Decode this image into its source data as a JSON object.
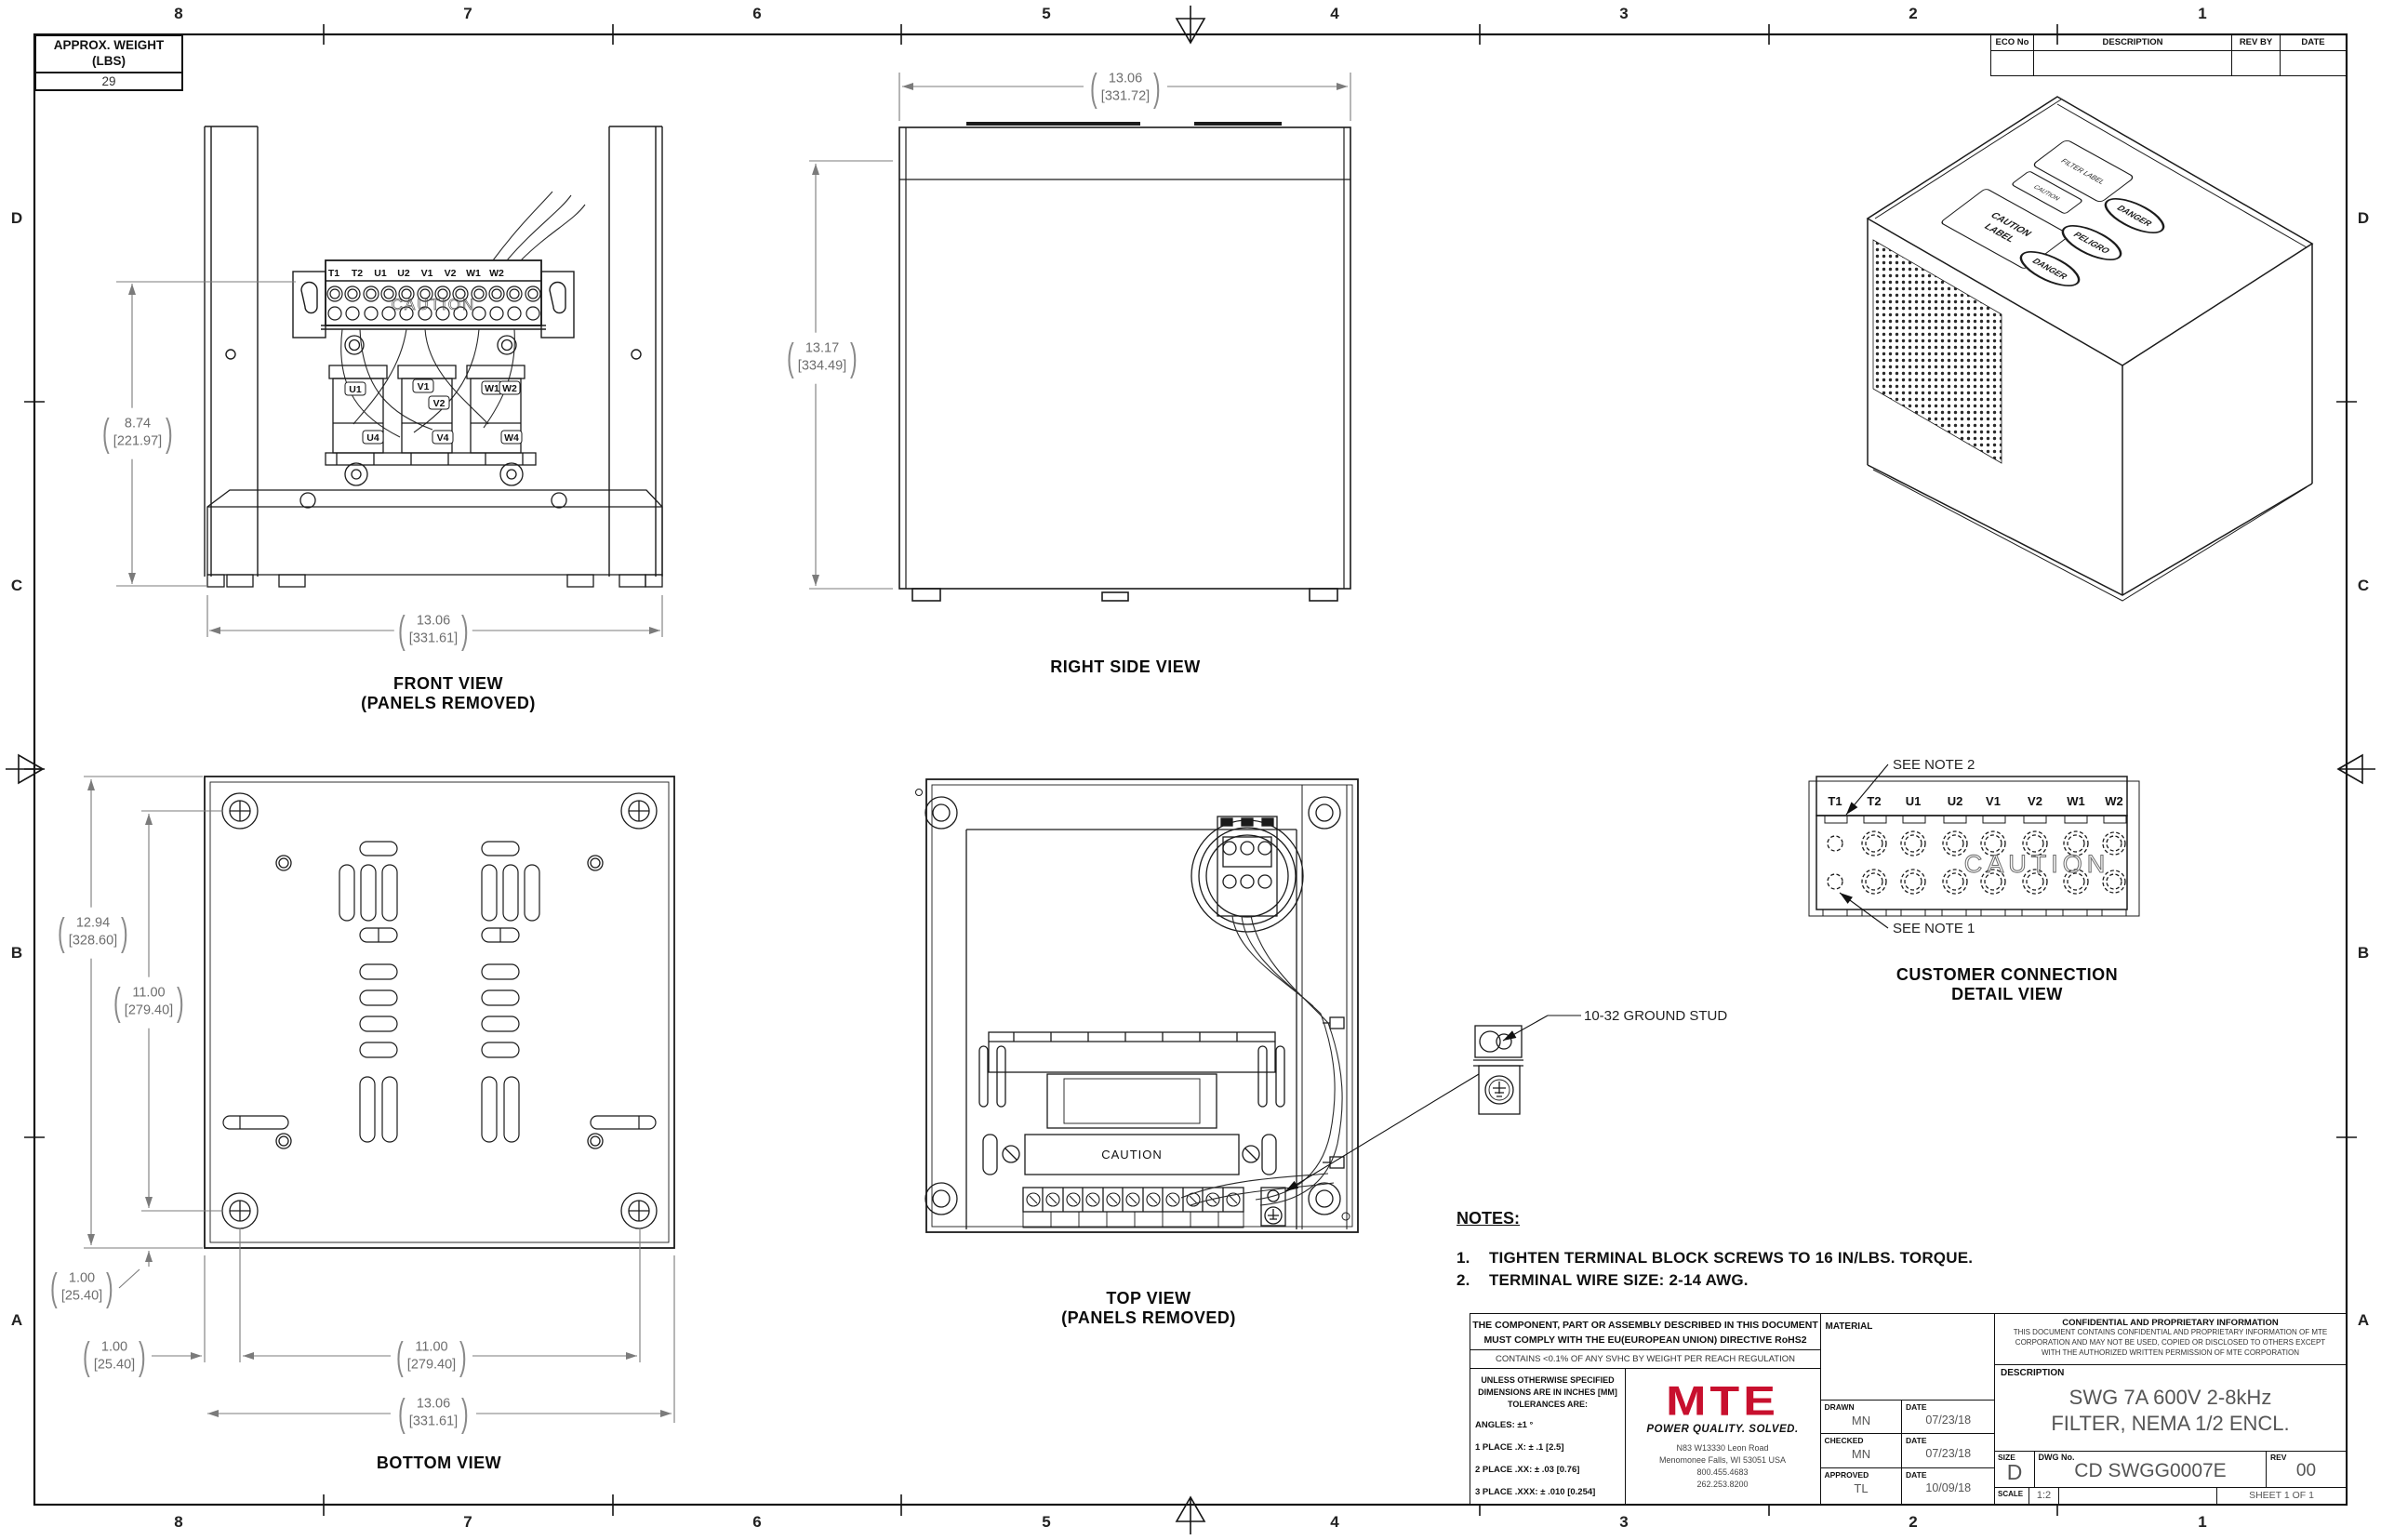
{
  "sheet": {
    "border": {
      "cols": [
        "8",
        "7",
        "6",
        "5",
        "4",
        "3",
        "2",
        "1"
      ],
      "rows": [
        "D",
        "C",
        "B",
        "A"
      ]
    },
    "weight_box": {
      "title_line1": "APPROX. WEIGHT",
      "title_line2": "(LBS)",
      "value": "29"
    },
    "eco_table": {
      "headers": [
        "ECO No",
        "DESCRIPTION",
        "REV BY",
        "DATE"
      ]
    }
  },
  "caution": "CAUTION",
  "terminals": [
    "T1",
    "T2",
    "U1",
    "U2",
    "V1",
    "V2",
    "W1",
    "W2"
  ],
  "front_components": {
    "u1": "U1",
    "v1": "V1",
    "v2": "V2",
    "w1": "W1",
    "w2": "W2",
    "u4": "U4",
    "v4": "V4",
    "w4": "W4"
  },
  "views": {
    "front": {
      "title": "FRONT VIEW",
      "subtitle": "(PANELS REMOVED)"
    },
    "right": {
      "title": "RIGHT SIDE VIEW"
    },
    "bottom": {
      "title": "BOTTOM VIEW"
    },
    "top": {
      "title": "TOP VIEW",
      "subtitle": "(PANELS REMOVED)"
    },
    "detail": {
      "title_line1": "CUSTOMER CONNECTION",
      "title_line2": "DETAIL VIEW",
      "see_note_1": "SEE NOTE 1",
      "see_note_2": "SEE NOTE 2"
    }
  },
  "callouts": {
    "ground_stud": "10-32 GROUND STUD"
  },
  "dims": {
    "front_height": {
      "in": "8.74",
      "mm": "[221.97]"
    },
    "front_width": {
      "in": "13.06",
      "mm": "[331.61]"
    },
    "side_width": {
      "in": "13.06",
      "mm": "[331.72]"
    },
    "side_height": {
      "in": "13.17",
      "mm": "[334.49]"
    },
    "bottom_height": {
      "in": "12.94",
      "mm": "[328.60]"
    },
    "bottom_hole_v": {
      "in": "11.00",
      "mm": "[279.40]"
    },
    "bottom_off_v": {
      "in": "1.00",
      "mm": "[25.40]"
    },
    "bottom_off_h": {
      "in": "1.00",
      "mm": "[25.40]"
    },
    "bottom_hole_h": {
      "in": "11.00",
      "mm": "[279.40]"
    },
    "bottom_width": {
      "in": "13.06",
      "mm": "[331.61]"
    }
  },
  "notes": {
    "header": "NOTES:",
    "items": [
      {
        "num": "1.",
        "text": "TIGHTEN TERMINAL BLOCK SCREWS TO 16 IN/LBS. TORQUE."
      },
      {
        "num": "2.",
        "text": "TERMINAL WIRE SIZE: 2-14 AWG."
      }
    ]
  },
  "iso_labels": {
    "filter": "FILTER LABEL",
    "small_caution": "CAUTION",
    "caution_l1": "CAUTION",
    "caution_l2": "LABEL",
    "danger_en": "DANGER",
    "danger_es": "PELIGRO",
    "danger_fr": "DANGER"
  },
  "title_block": {
    "compliance_line1": "THE COMPONENT, PART OR ASSEMBLY DESCRIBED IN THIS DOCUMENT",
    "compliance_line2": "MUST COMPLY WITH THE EU(EUROPEAN UNION) DIRECTIVE RoHS2",
    "reach": "CONTAINS <0.1% OF ANY SVHC BY WEIGHT PER REACH REGULATION",
    "material_label": "MATERIAL",
    "tolerances": {
      "l1": "UNLESS OTHERWISE SPECIFIED",
      "l2": "DIMENSIONS ARE IN INCHES [MM]",
      "l3": "TOLERANCES ARE:",
      "angles": "ANGLES: ±1 °",
      "p1": "1 PLACE .X: ± .1 [2.5]",
      "p2": "2 PLACE .XX: ± .03 [0.76]",
      "p3": "3 PLACE .XXX: ± .010 [0.254]"
    },
    "logo_text": "MTE",
    "tagline": "POWER QUALITY. SOLVED.",
    "address": [
      "N83 W13330 Leon Road",
      "Menomonee Falls, WI 53051 USA",
      "800.455.4683",
      "262.253.8200"
    ],
    "sign_rows": [
      {
        "role": "DRAWN",
        "name": "MN",
        "date_label": "DATE",
        "date": "07/23/18"
      },
      {
        "role": "CHECKED",
        "name": "MN",
        "date_label": "DATE",
        "date": "07/23/18"
      },
      {
        "role": "APPROVED",
        "name": "TL",
        "date_label": "DATE",
        "date": "10/09/18"
      }
    ],
    "confidential_title": "CONFIDENTIAL AND PROPRIETARY INFORMATION",
    "confidential_l1": "THIS DOCUMENT CONTAINS CONFIDENTIAL AND PROPRIETARY INFORMATION OF MTE",
    "confidential_l2": "CORPORATION AND MAY NOT BE USED, COPIED OR DISCLOSED TO OTHERS EXCEPT",
    "confidential_l3": "WITH THE AUTHORIZED WRITTEN PERMISSION OF MTE CORPORATION",
    "description_label": "DESCRIPTION",
    "description_line1": "SWG 7A 600V 2-8kHz",
    "description_line2": "FILTER, NEMA 1/2 ENCL.",
    "size_label": "SIZE",
    "size": "D",
    "dwg_label": "DWG No.",
    "dwg_no": "CD SWGG0007E",
    "rev_label": "REV",
    "rev": "00",
    "scale_label": "SCALE",
    "scale": "1:2",
    "sheet_label": "SHEET 1  OF 1",
    "colors": {
      "logo_red": "#c8102e"
    }
  }
}
